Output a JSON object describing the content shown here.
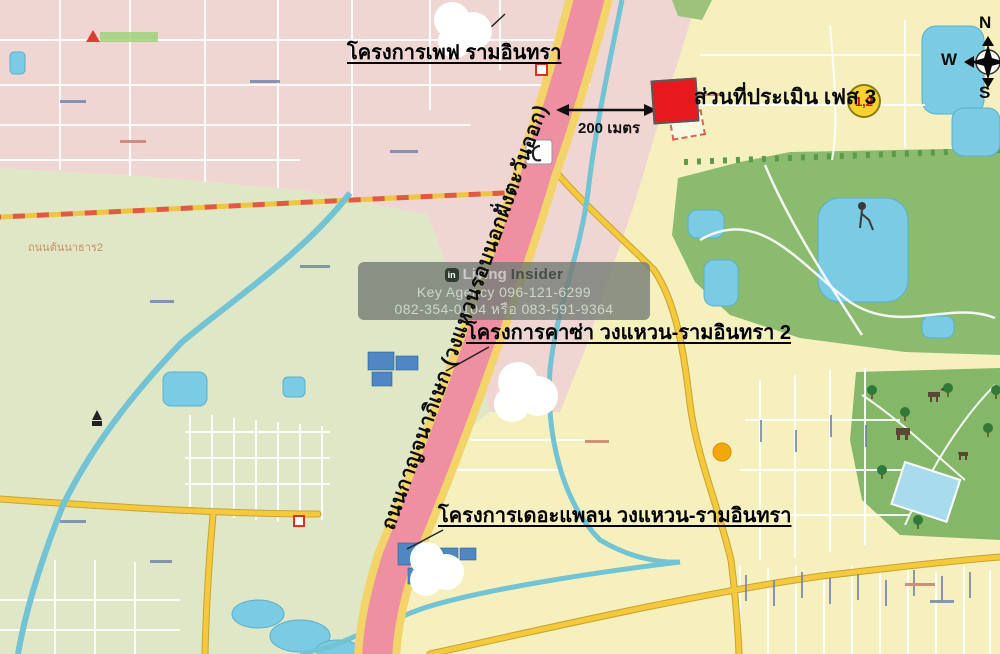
{
  "map": {
    "labels": {
      "project_pave": "โครงการเพฟ รามอินทรา",
      "project_casa": "โครงการคาซ่า วงแหวน-รามอินทรา 2",
      "project_theplan": "โครงการเดอะแพลน วงแหวน-รามอินทรา",
      "evaluated_area": "ส่วนที่ประเมิน เฟส 3",
      "phase_badge": "1,2",
      "distance": "200 เมตร",
      "ring_road": "ถนนกาญจนาภิเษก (วงแหวนรอบนอกฝั่งตะวันออก)",
      "street_left": "ถนนต้นนาธาร2"
    },
    "compass": {
      "north": "N",
      "west": "W",
      "south": "S"
    },
    "watermark": {
      "logo": "in",
      "brand_living": "Living",
      "brand_insider": "Insider",
      "line2": "Key Agency 096-121-6299",
      "line3": "082-354-0104 หรือ 083-591-9364"
    },
    "colors": {
      "base_yellow": "#f6f0be",
      "pink_zone": "#efd6d2",
      "green_zone": "#dfe7c6",
      "golf_green": "#8abb6e",
      "safari_green": "#84b868",
      "highway_pink": "#ee8fa2",
      "highway_casing": "#f2d468",
      "yellow_road": "#f4c93e",
      "water": "#7ccbe4",
      "canal": "#72c3d4",
      "marker_red": "#e8191c",
      "badge_yellow": "#f8d22e"
    }
  }
}
